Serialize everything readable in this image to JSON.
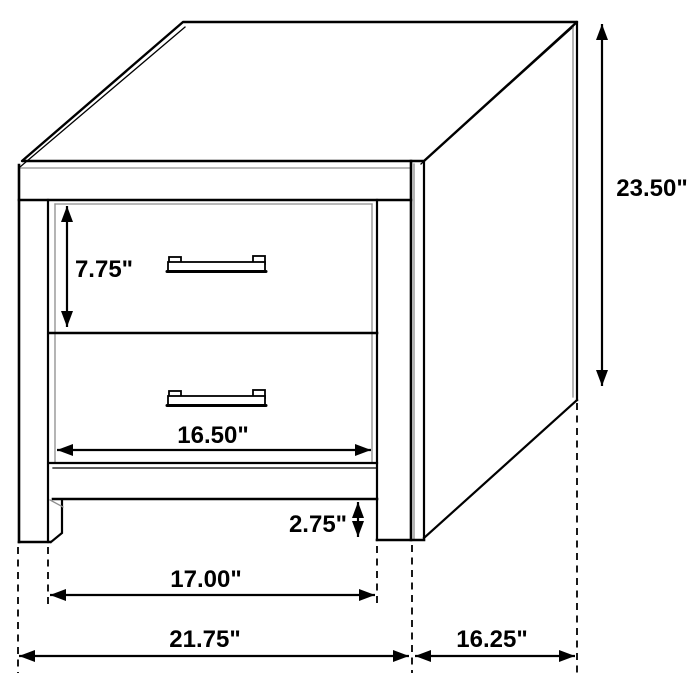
{
  "diagram": {
    "subject": "nightstand-two-drawer-dimension-drawing",
    "colors": {
      "line": "#000000",
      "background": "#ffffff",
      "shade_line": "#8d8d8d"
    },
    "dimensions": {
      "overall_height": "23.50\"",
      "top_drawer_height": "7.75\"",
      "drawer_width": "16.50\"",
      "foot_clearance": "2.75\"",
      "between_legs_width": "17.00\"",
      "overall_width": "21.75\"",
      "overall_depth": "16.25\""
    }
  }
}
